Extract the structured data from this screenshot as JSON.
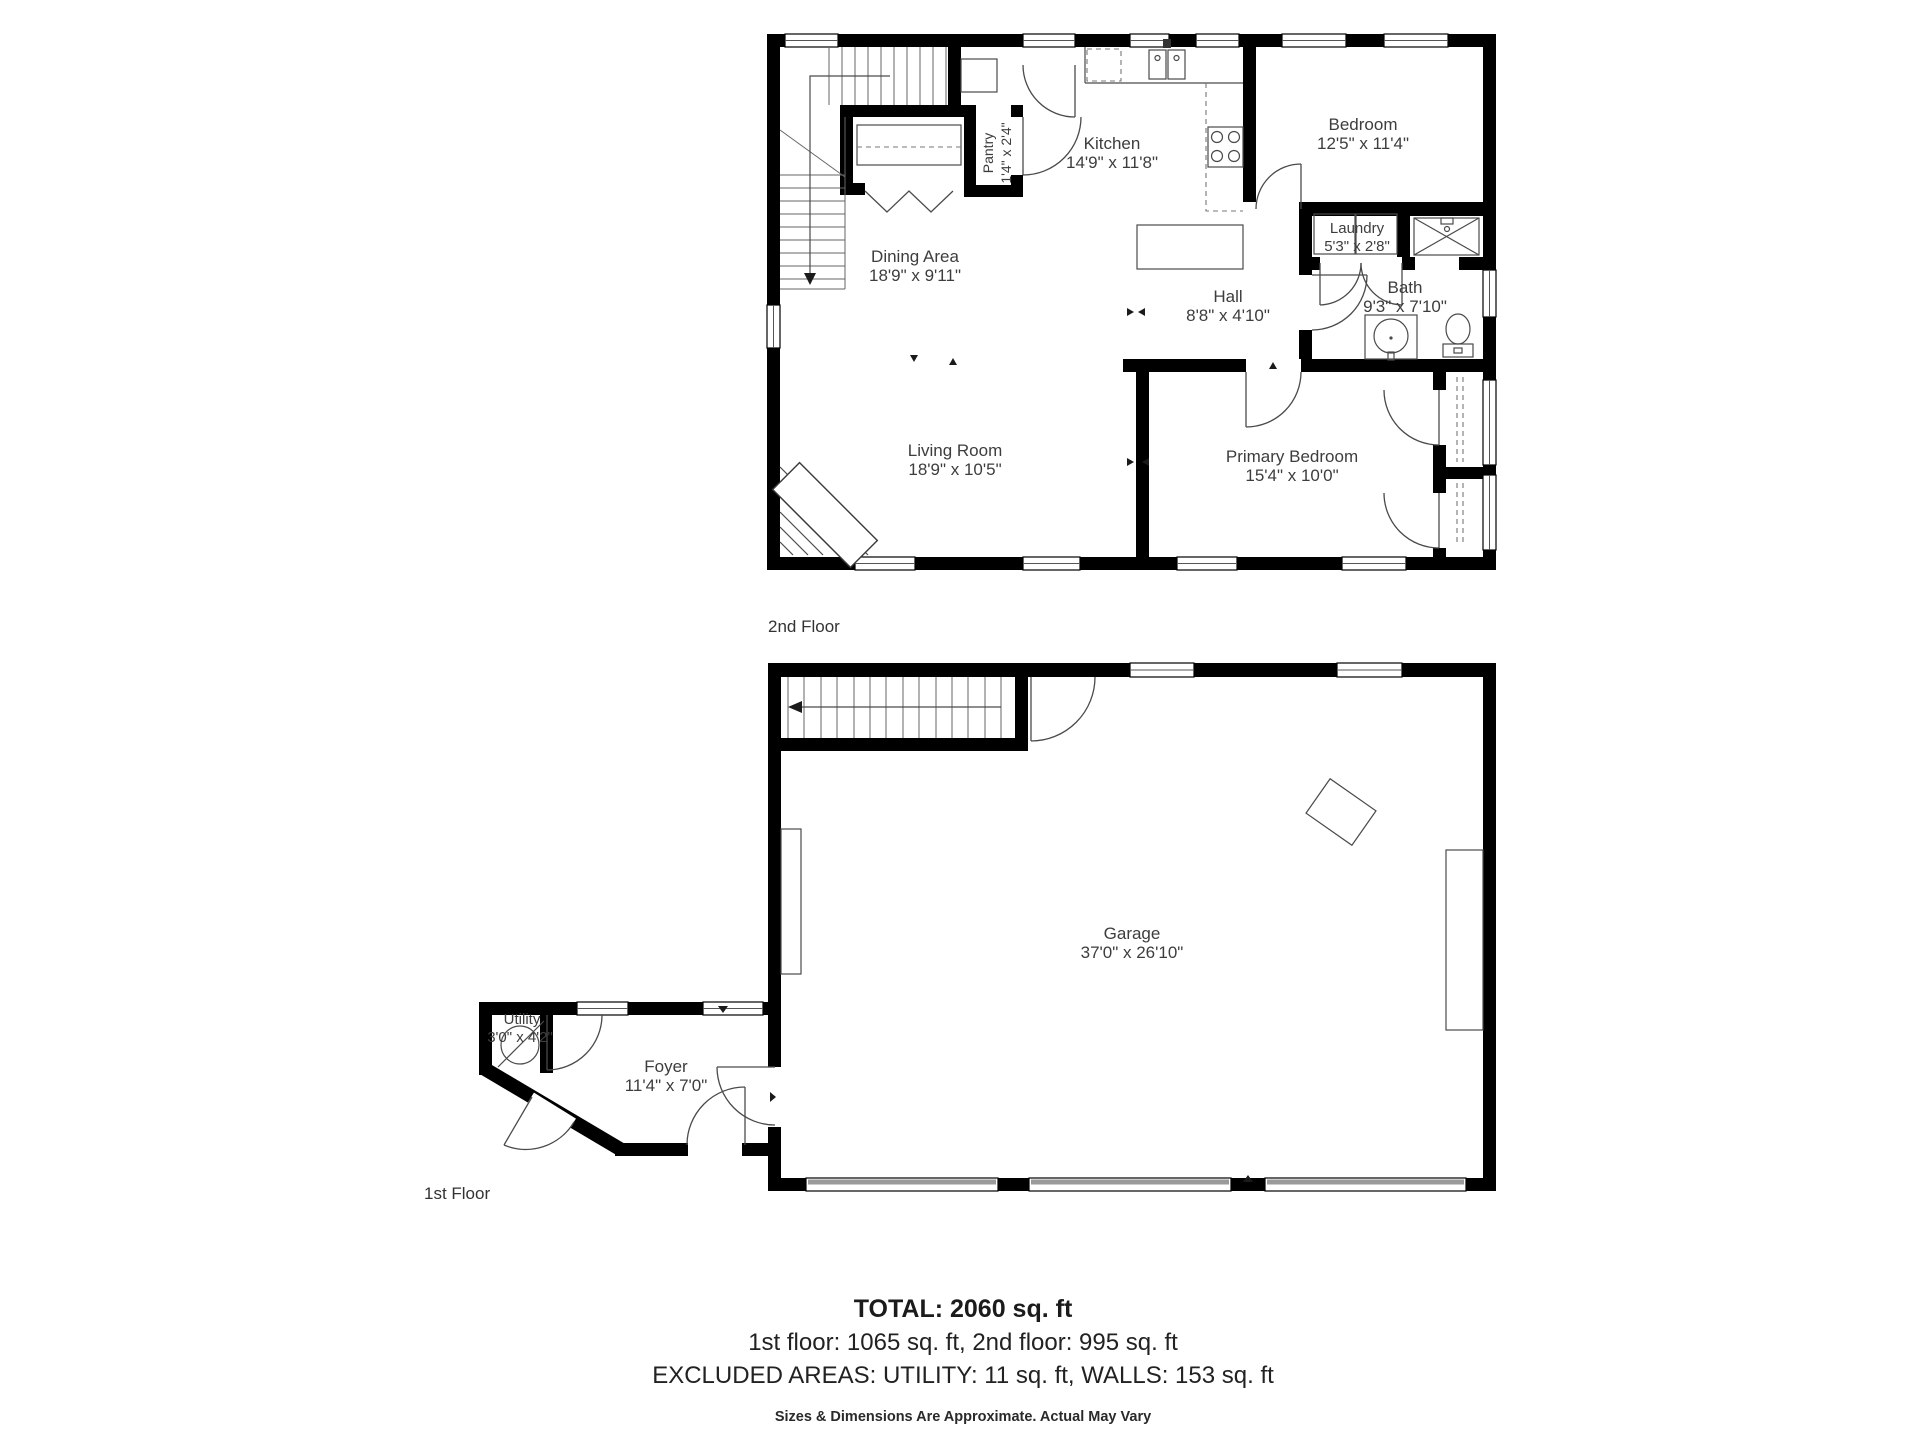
{
  "floor2": {
    "caption": "2nd Floor",
    "rooms": {
      "kitchen": {
        "name": "Kitchen",
        "dims": "14'9\" x 11'8\""
      },
      "bedroom": {
        "name": "Bedroom",
        "dims": "12'5\" x 11'4\""
      },
      "dining": {
        "name": "Dining Area",
        "dims": "18'9\" x 9'11\""
      },
      "hall": {
        "name": "Hall",
        "dims": "8'8\" x 4'10\""
      },
      "laundry": {
        "name": "Laundry",
        "dims": "5'3\" x 2'8\""
      },
      "bath": {
        "name": "Bath",
        "dims": "9'3\" x 7'10\""
      },
      "living": {
        "name": "Living Room",
        "dims": "18'9\" x 10'5\""
      },
      "primary": {
        "name": "Primary Bedroom",
        "dims": "15'4\" x 10'0\""
      },
      "pantry": {
        "name": "Pantry",
        "dims": "1'4\" x 2'4\""
      }
    }
  },
  "floor1": {
    "caption": "1st Floor",
    "rooms": {
      "garage": {
        "name": "Garage",
        "dims": "37'0\" x 26'10\""
      },
      "utility": {
        "name": "Utility",
        "dims": "3'0\" x 4'2\""
      },
      "foyer": {
        "name": "Foyer",
        "dims": "11'4\" x 7'0\""
      }
    }
  },
  "summary": {
    "total": "TOTAL: 2060 sq. ft",
    "floors": "1st floor: 1065 sq. ft, 2nd floor: 995 sq. ft",
    "excluded": "EXCLUDED AREAS: UTILITY: 11 sq. ft, WALLS: 153 sq. ft",
    "disclaimer": "Sizes & Dimensions Are Approximate. Actual May Vary"
  },
  "colors": {
    "wall": "#000000",
    "label": "#3d3d3d",
    "line": "#4a4a4a"
  }
}
